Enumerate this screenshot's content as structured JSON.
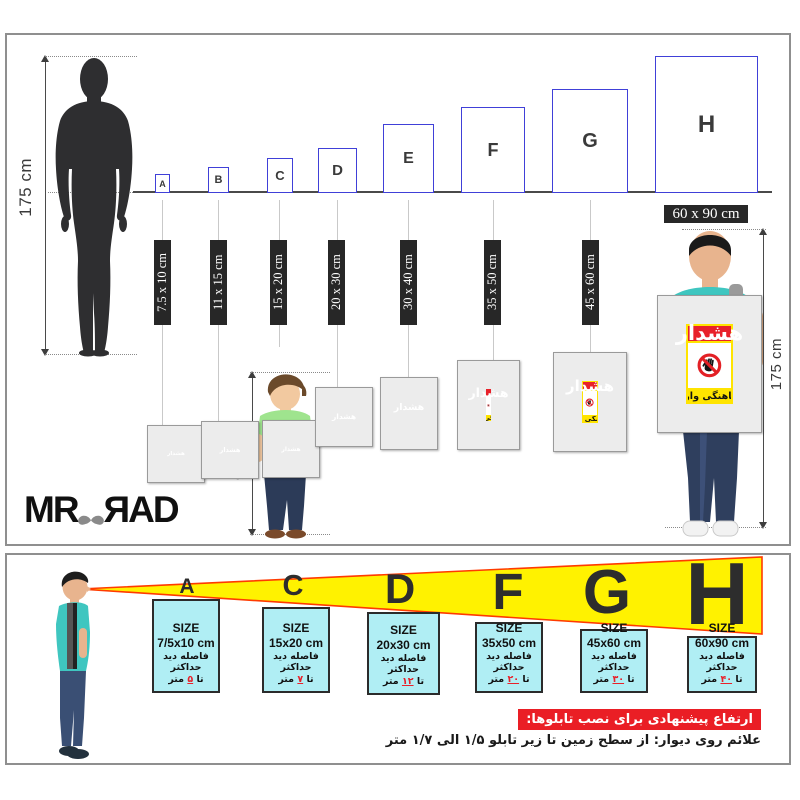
{
  "sign": {
    "header": "هشدار",
    "footer": "بدون هماهنگی وارد نشوید"
  },
  "top_panel": {
    "person_height": "175 cm",
    "child_height": "90 cm",
    "man_height": "175 cm",
    "big_size_label": "60 x 90 cm",
    "boxes": [
      {
        "letter": "A",
        "size": "7.5 x 10 cm"
      },
      {
        "letter": "B",
        "size": "11 x 15 cm"
      },
      {
        "letter": "C",
        "size": "15 x 20 cm"
      },
      {
        "letter": "D",
        "size": "20 x 30 cm"
      },
      {
        "letter": "E",
        "size": "30 x 40 cm"
      },
      {
        "letter": "F",
        "size": "35 x 50 cm"
      },
      {
        "letter": "G",
        "size": "45 x 60 cm"
      },
      {
        "letter": "H",
        "size": "60 x 90 cm"
      }
    ],
    "logo": {
      "left": "MR",
      "right": "ЯAD"
    }
  },
  "bottom_panel": {
    "letters": [
      "A",
      "C",
      "D",
      "F",
      "G",
      "H"
    ],
    "boxes": [
      {
        "letter": "A",
        "size_title": "SIZE",
        "size": "7/5x10 cm",
        "line": "فاصله دید حداکثر",
        "to": "تا",
        "value": "۵",
        "unit": "متر"
      },
      {
        "letter": "C",
        "size_title": "SIZE",
        "size": "15x20 cm",
        "line": "فاصله دید حداکثر",
        "to": "تا",
        "value": "۷",
        "unit": "متر"
      },
      {
        "letter": "D",
        "size_title": "SIZE",
        "size": "20x30 cm",
        "line": "فاصله دید حداکثر",
        "to": "تا",
        "value": "۱۲",
        "unit": "متر"
      },
      {
        "letter": "F",
        "size_title": "SIZE",
        "size": "35x50 cm",
        "line": "فاصله دید حداکثر",
        "to": "تا",
        "value": "۲۰",
        "unit": "متر"
      },
      {
        "letter": "G",
        "size_title": "SIZE",
        "size": "45x60 cm",
        "line": "فاصله دید حداکثر",
        "to": "تا",
        "value": "۳۰",
        "unit": "متر"
      },
      {
        "letter": "H",
        "size_title": "SIZE",
        "size": "60x90 cm",
        "line": "فاصله دید حداکثر",
        "to": "تا",
        "value": "۴۰",
        "unit": "متر"
      }
    ],
    "heading": "ارتفاع پیشنهادی برای نصب تابلوها:",
    "note": "علائم روی دیوار: از سطح زمین تا زیر تابلو ۱/۵ الی ۱/۷ متر"
  },
  "colors": {
    "sign_red": "#e8212a",
    "sign_yellow": "#ffe400",
    "cone_yellow": "#fff200",
    "cone_edge": "#ff3b00",
    "cyan_box": "#b0eef4",
    "blue_border": "#4040d8"
  }
}
